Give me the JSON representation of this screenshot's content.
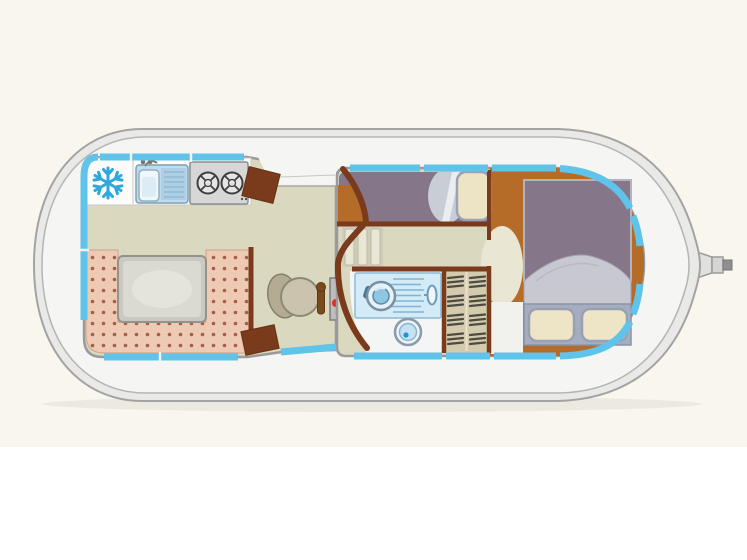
{
  "image": {
    "description": "Top-down interior floor plan of a canal houseboat",
    "width": 747,
    "height": 560
  },
  "colors": {
    "background_top": "#f9f6ee",
    "background_bottom": "#ffffff",
    "hull": "#e9e9e8",
    "hull_outline": "#a3a3a3",
    "deck": "#f5f5f3",
    "deck_outline": "#b5b5b5",
    "window_blue": "#5fc3ea",
    "cabin_outline": "#9a9a9a",
    "wall_brown": "#7a3a1c",
    "floor_beige": "#dbd8c0",
    "dinette_salmon": "#eec9b3",
    "dinette_dot": "#a2604a",
    "table_gray": "#dadad2",
    "counter_white": "#fcfcfb",
    "stove_gray": "#d7d7d7",
    "freezer_blue": "#2fa8dc",
    "sink_blue": "#bfdcee",
    "berth_purple": "#85768a",
    "pillow_cream": "#ece4c4",
    "blanket_gray": "#c8c8d0",
    "bed_base_gray": "#a6adbf",
    "bedroom_floor_orange": "#b56c28",
    "bathroom_white": "#f4f6f6",
    "shower_blue": "#d2ebf7",
    "closet_tan": "#d4caae",
    "console_gray": "#bdbdbd",
    "console_red": "#dc2f1d",
    "console_green": "#7fc13e",
    "seat_tan": "#ccc3ae",
    "oval_cream": "#e9e6d3",
    "entry_patch": "#f1f1ed",
    "rudder_gray": "#d6d6d5"
  },
  "icons": {
    "freezer": "snowflake-icon",
    "stove": "two-burner-icon",
    "shower": "shower-head-icon"
  }
}
